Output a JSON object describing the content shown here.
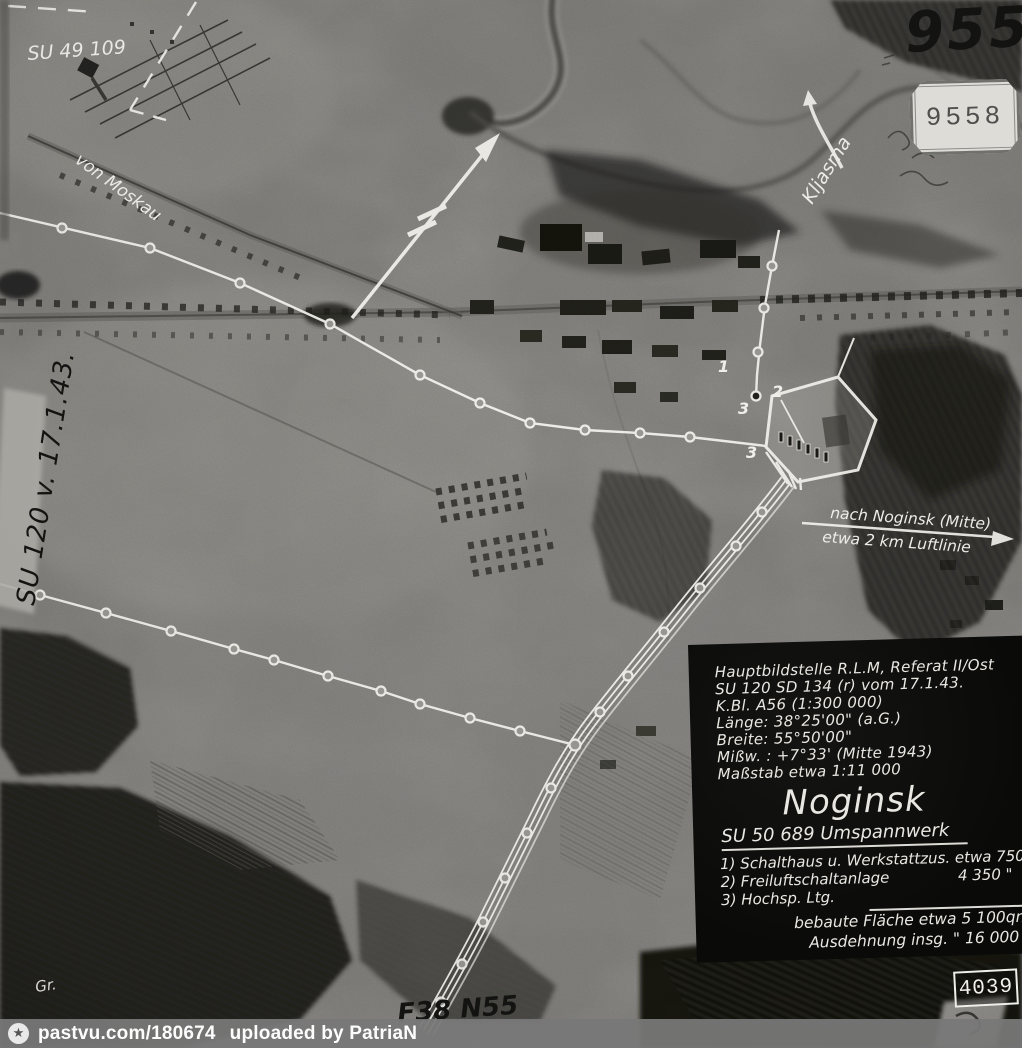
{
  "marks": {
    "su49109": "SU 49 109",
    "left_strip": "SU 120 v. 17.1.43.",
    "hand_number": "9558",
    "stamp_number": "9558",
    "bottom_stamp": "4039",
    "initials": "Gr.",
    "bottom_note": "F38 N55"
  },
  "annotations": {
    "river": "Kljasma",
    "road": "von Moskau",
    "direction_line1": "nach Noginsk (Mitte)",
    "direction_line2": "etwa 2 km Luftlinie",
    "site_numbers": [
      "1",
      "2",
      "3",
      "3"
    ]
  },
  "info_panel": {
    "lines": [
      "Hauptbildstelle R.L.M, Referat II/Ost",
      "SU 120 SD 134 (r) vom 17.1.43.",
      "K.Bl. A56 (1:300 000)",
      "Länge: 38°25'00\" (a.G.)",
      "Breite: 55°50'00\"",
      "Mißw. : +7°33' (Mitte 1943)",
      "Maßstab etwa 1:11 000"
    ],
    "title": "Noginsk",
    "subtitle": "SU 50 689 Umspannwerk",
    "items": [
      {
        "label": "1) Schalthaus u. Werkstatt",
        "value": "zus. etwa 750qm"
      },
      {
        "label": "2) Freiluftschaltanlage",
        "value": "4 350 \""
      },
      {
        "label": "3) Hochsp. Ltg.",
        "value": ""
      }
    ],
    "totals": [
      "bebaute Fläche etwa 5 100qm",
      "Ausdehnung insg.  \" 16 000 \""
    ]
  },
  "watermark": {
    "icon": "star-in-circle",
    "link": "pastvu.com/180674",
    "credit": "uploaded by PatriaN"
  },
  "colors": {
    "photo_base": "#9c9a95",
    "annotation_white": "#f4f3ee",
    "panel_bg": "#0b0b0a",
    "panel_text": "#e9e7e1",
    "watermark_bg": "#787878"
  }
}
